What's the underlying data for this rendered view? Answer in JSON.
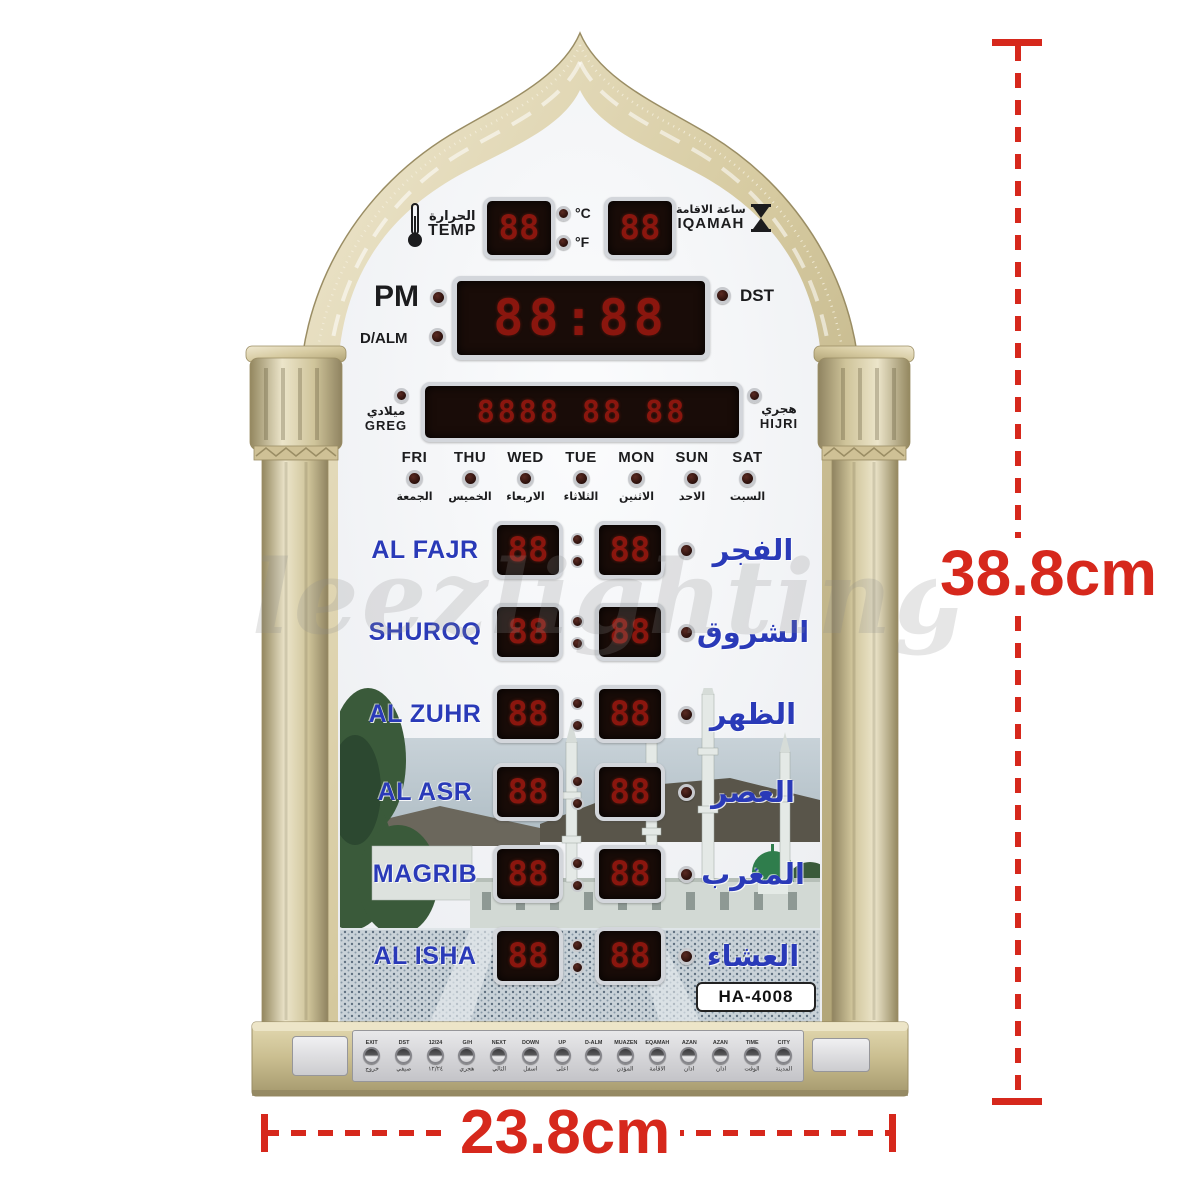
{
  "meta": {
    "subject": "Islamic azan prayer-times wall clock product photo with size annotations"
  },
  "annotations": {
    "height_label": "38.8cm",
    "width_label": "23.8cm"
  },
  "watermark": "leezlighting",
  "model_label": "HA-4008",
  "colors": {
    "accent_red": "#d6281c",
    "frame_gold": "#cfc196",
    "label_blue": "#2a3ab8",
    "led_digit_red": "#8a160e",
    "led_panel": "#190c08",
    "face_white": "#f4f5f7"
  },
  "clock": {
    "temp": {
      "arabic": "الحرارة",
      "english": "TEMP",
      "display": "88",
      "celsius_label": "°C",
      "fahrenheit_label": "°F"
    },
    "iqamah": {
      "arabic": "ساعة الاقامة",
      "english": "IQAMAH",
      "display": "88"
    },
    "time": {
      "pm_label": "PM",
      "dalm_label": "D/ALM",
      "dst_label": "DST",
      "display": "88:88"
    },
    "date": {
      "greg_arabic": "ميلادي",
      "greg_label": "GREG",
      "display": "8888 88 88",
      "hijri_arabic": "هجري",
      "hijri_label": "HIJRI"
    },
    "days": [
      {
        "en": "FRI",
        "ar": "الجمعة"
      },
      {
        "en": "THU",
        "ar": "الخميس"
      },
      {
        "en": "WED",
        "ar": "الاربعاء"
      },
      {
        "en": "TUE",
        "ar": "الثلاثاء"
      },
      {
        "en": "MON",
        "ar": "الاثنين"
      },
      {
        "en": "SUN",
        "ar": "الاحد"
      },
      {
        "en": "SAT",
        "ar": "السبت"
      }
    ],
    "prayers": [
      {
        "en": "AL FAJR",
        "ar": "الفجر",
        "hh": "88",
        "mm": "88"
      },
      {
        "en": "SHUROQ",
        "ar": "الشروق",
        "hh": "88",
        "mm": "88"
      },
      {
        "en": "AL ZUHR",
        "ar": "الظهر",
        "hh": "88",
        "mm": "88"
      },
      {
        "en": "AL ASR",
        "ar": "العصر",
        "hh": "88",
        "mm": "88"
      },
      {
        "en": "MAGRIB",
        "ar": "المغرب",
        "hh": "88",
        "mm": "88"
      },
      {
        "en": "AL ISHA",
        "ar": "العشاء",
        "hh": "88",
        "mm": "88"
      }
    ],
    "buttons": [
      {
        "en": "EXIT",
        "ar": "خروج"
      },
      {
        "en": "DST",
        "ar": "صيفي"
      },
      {
        "en": "12/24",
        "ar": "١٢/٢٤"
      },
      {
        "en": "G/H",
        "ar": "هجري"
      },
      {
        "en": "NEXT",
        "ar": "التالي"
      },
      {
        "en": "DOWN",
        "ar": "اسفل"
      },
      {
        "en": "UP",
        "ar": "اعلى"
      },
      {
        "en": "D-ALM",
        "ar": "منبه"
      },
      {
        "en": "MUAZEN",
        "ar": "المؤذن"
      },
      {
        "en": "EQAMAH",
        "ar": "الاقامة"
      },
      {
        "en": "AZAN",
        "ar": "اذان"
      },
      {
        "en": "AZAN",
        "ar": "اذان"
      },
      {
        "en": "TIME",
        "ar": "الوقت"
      },
      {
        "en": "CITY",
        "ar": "المدينة"
      }
    ]
  }
}
